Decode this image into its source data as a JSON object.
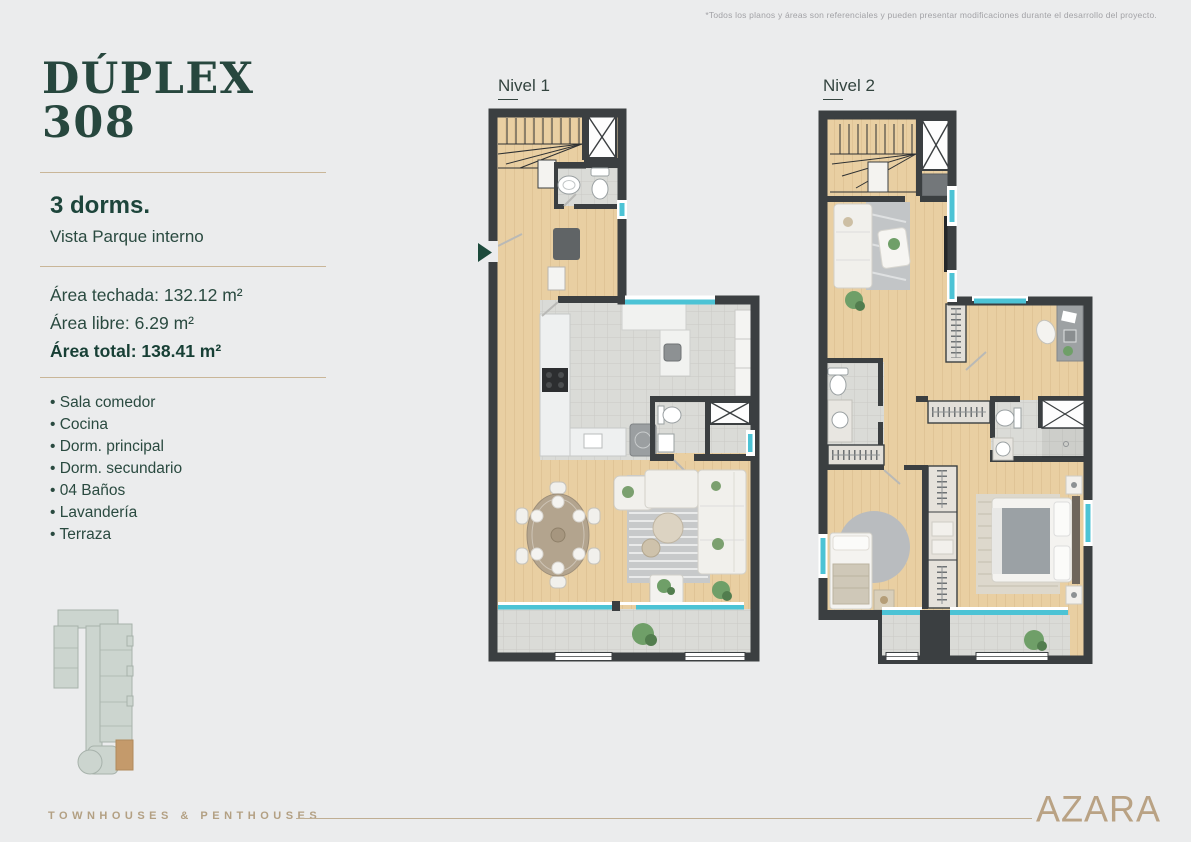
{
  "page": {
    "disclaimer": "*Todos los planos y áreas son referenciales y pueden presentar modificaciones durante el desarrollo del proyecto."
  },
  "unit": {
    "title_line1": "DÚPLEX",
    "title_line2": "308",
    "bedrooms": "3 dorms.",
    "view": "Vista Parque interno",
    "areas": [
      {
        "label": "Área techada:",
        "value": "132.12 m²"
      },
      {
        "label": "Área libre:",
        "value": "6.29 m²"
      },
      {
        "label": "Área total:",
        "value": "138.41 m²"
      }
    ]
  },
  "features": [
    "Sala comedor",
    "Cocina",
    "Dorm. principal",
    "Dorm. secundario",
    "04 Baños",
    "Lavandería",
    "Terraza"
  ],
  "plans": {
    "nivel1": {
      "label": "Nivel 1"
    },
    "nivel2": {
      "label": "Nivel 2"
    }
  },
  "footer": {
    "tagline": "TOWNHOUSES & PENTHOUSES",
    "brand": "AZARA"
  },
  "colors": {
    "background": "#ebeced",
    "brand_green": "#27473e",
    "brand_tan": "#b5a083",
    "wall": "#3b3f41",
    "wood_floor": "#e9cfa2",
    "tile": "#dadbd7",
    "glass_teal": "#4cc3d5",
    "unit_highlight": "#c49a6b",
    "entrance_arrow": "#1c4a3b"
  }
}
